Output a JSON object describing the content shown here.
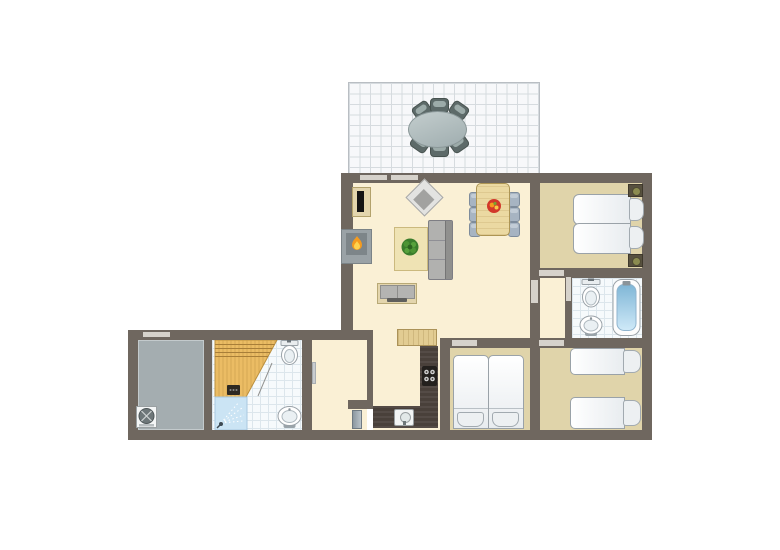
{
  "diagram": {
    "type": "apartment-floor-plan",
    "description": "top-down holiday-home floor plan with terrace, open living-dining room, kitchen, three bedrooms, two bathrooms, sauna with shower and storage room"
  },
  "colors": {
    "wall": "#6F675F",
    "floor_living": "#FAF0D5",
    "floor_bedroom": "#E0D4AA",
    "floor_tile": "#F6FAFC",
    "tile_line": "#DCE6EC",
    "floor_storage": "#A4ADB0",
    "terrace_bg": "#F7F8FA",
    "terrace_grid": "#D6DBDF",
    "terrace_chair": "#5D6A69",
    "terrace_table": "#AEBCBC",
    "door": "#D6D2CB",
    "counter_dark": "#49403A",
    "wood_light": "#E2CC92",
    "sauna_wood": "#EBBC64",
    "shower_blue": "#CBE4F4",
    "tub_blue_dark": "#7FB6D6",
    "tub_blue_light": "#CFE9F8",
    "bed_white": "#F4F6F8",
    "fixture_outline": "#9AA2A8",
    "sofa_gray": "#B1B1AF",
    "chair_blue": "#A7B4C2",
    "table_wood": "#EBD9A2",
    "rug": "#EFE3B4",
    "plant_green": "#3A7D2C",
    "flame_orange": "#F59B1E",
    "flame_yellow": "#FFD34E",
    "fruit_red": "#D2382A"
  },
  "rooms": [
    {
      "id": "terrace",
      "name": "terrace",
      "furniture": [
        "oval-patio-table",
        "patio-chair x6"
      ]
    },
    {
      "id": "living-dining",
      "name": "living-dining-room",
      "furniture": [
        "tv-cabinet",
        "fireplace",
        "armchair",
        "rug-with-plant",
        "sofa",
        "sideboard",
        "dining-table",
        "dining-chair x6",
        "fruit-bowl"
      ]
    },
    {
      "id": "kitchen",
      "name": "kitchen",
      "furniture": [
        "kitchen-island",
        "l-shaped-counter",
        "stove",
        "kitchen-sink"
      ]
    },
    {
      "id": "corridor",
      "name": "corridor",
      "furniture": []
    },
    {
      "id": "entry-hall",
      "name": "entry-hall",
      "furniture": [
        "entry-door-leaf"
      ]
    },
    {
      "id": "bedroom-1",
      "name": "double-bedroom",
      "furniture": [
        "double-bed",
        "pillow x2",
        "nightstand-lamp x2"
      ]
    },
    {
      "id": "bathroom-1",
      "name": "bathroom-with-bathtub",
      "furniture": [
        "toilet",
        "washbasin",
        "bathtub"
      ]
    },
    {
      "id": "bedroom-2",
      "name": "twin-bedroom-right",
      "furniture": [
        "single-bed x2",
        "pillow x2"
      ]
    },
    {
      "id": "bedroom-3",
      "name": "twin-bedroom-middle",
      "furniture": [
        "single-bed x2",
        "pillow x2"
      ]
    },
    {
      "id": "bathroom-2",
      "name": "bathroom-with-sauna",
      "furniture": [
        "sauna",
        "sauna-heater",
        "shower",
        "toilet",
        "washbasin",
        "door-swing"
      ]
    },
    {
      "id": "storage",
      "name": "storage-room",
      "furniture": [
        "ventilation-fan-unit"
      ]
    }
  ],
  "markers": {
    "windows": 3,
    "door-openings": 6,
    "door-leaves": 2
  }
}
